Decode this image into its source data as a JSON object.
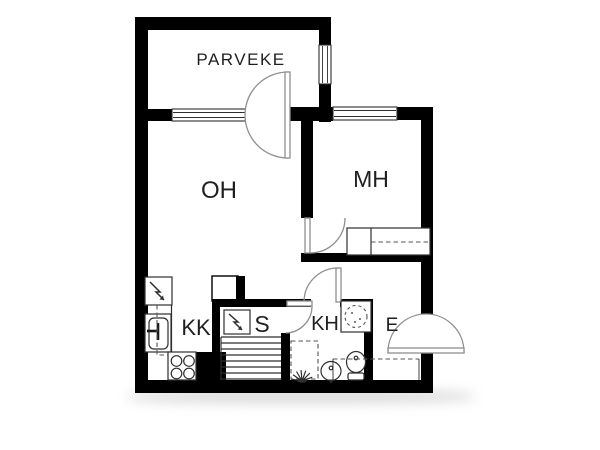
{
  "document": {
    "title": "Apartment floor plan"
  },
  "colors": {
    "wall": "#000000",
    "fixture_line": "#2e2e2e",
    "door_arc": "#8f8f8f",
    "background": "#ffffff",
    "shadow": "#b9b9b9"
  },
  "rooms": [
    {
      "id": "parveke",
      "label": "PARVEKE"
    },
    {
      "id": "oh",
      "label": "OH"
    },
    {
      "id": "mh",
      "label": "MH"
    },
    {
      "id": "kk",
      "label": "KK"
    },
    {
      "id": "s",
      "label": "S"
    },
    {
      "id": "kh",
      "label": "KH"
    },
    {
      "id": "e",
      "label": "E"
    }
  ],
  "icons": [
    "balcony-door-icon",
    "entrance-door-icon",
    "bedroom-door-icon",
    "bathroom-door-icon",
    "sauna-door-icon",
    "window-living-icon",
    "window-bedroom-icon",
    "window-balcony-icon",
    "bed-icon",
    "refrigerator-icon",
    "kitchen-sink-icon",
    "faucet-icon",
    "stove-icon",
    "duct-shaft-icon",
    "sauna-heater-icon",
    "lightning-icon",
    "sauna-benches-icon",
    "floor-drain-icon",
    "washing-machine-space-icon",
    "shower-icon",
    "washbasin-icon",
    "toilet-icon",
    "wardrobe-icon"
  ]
}
